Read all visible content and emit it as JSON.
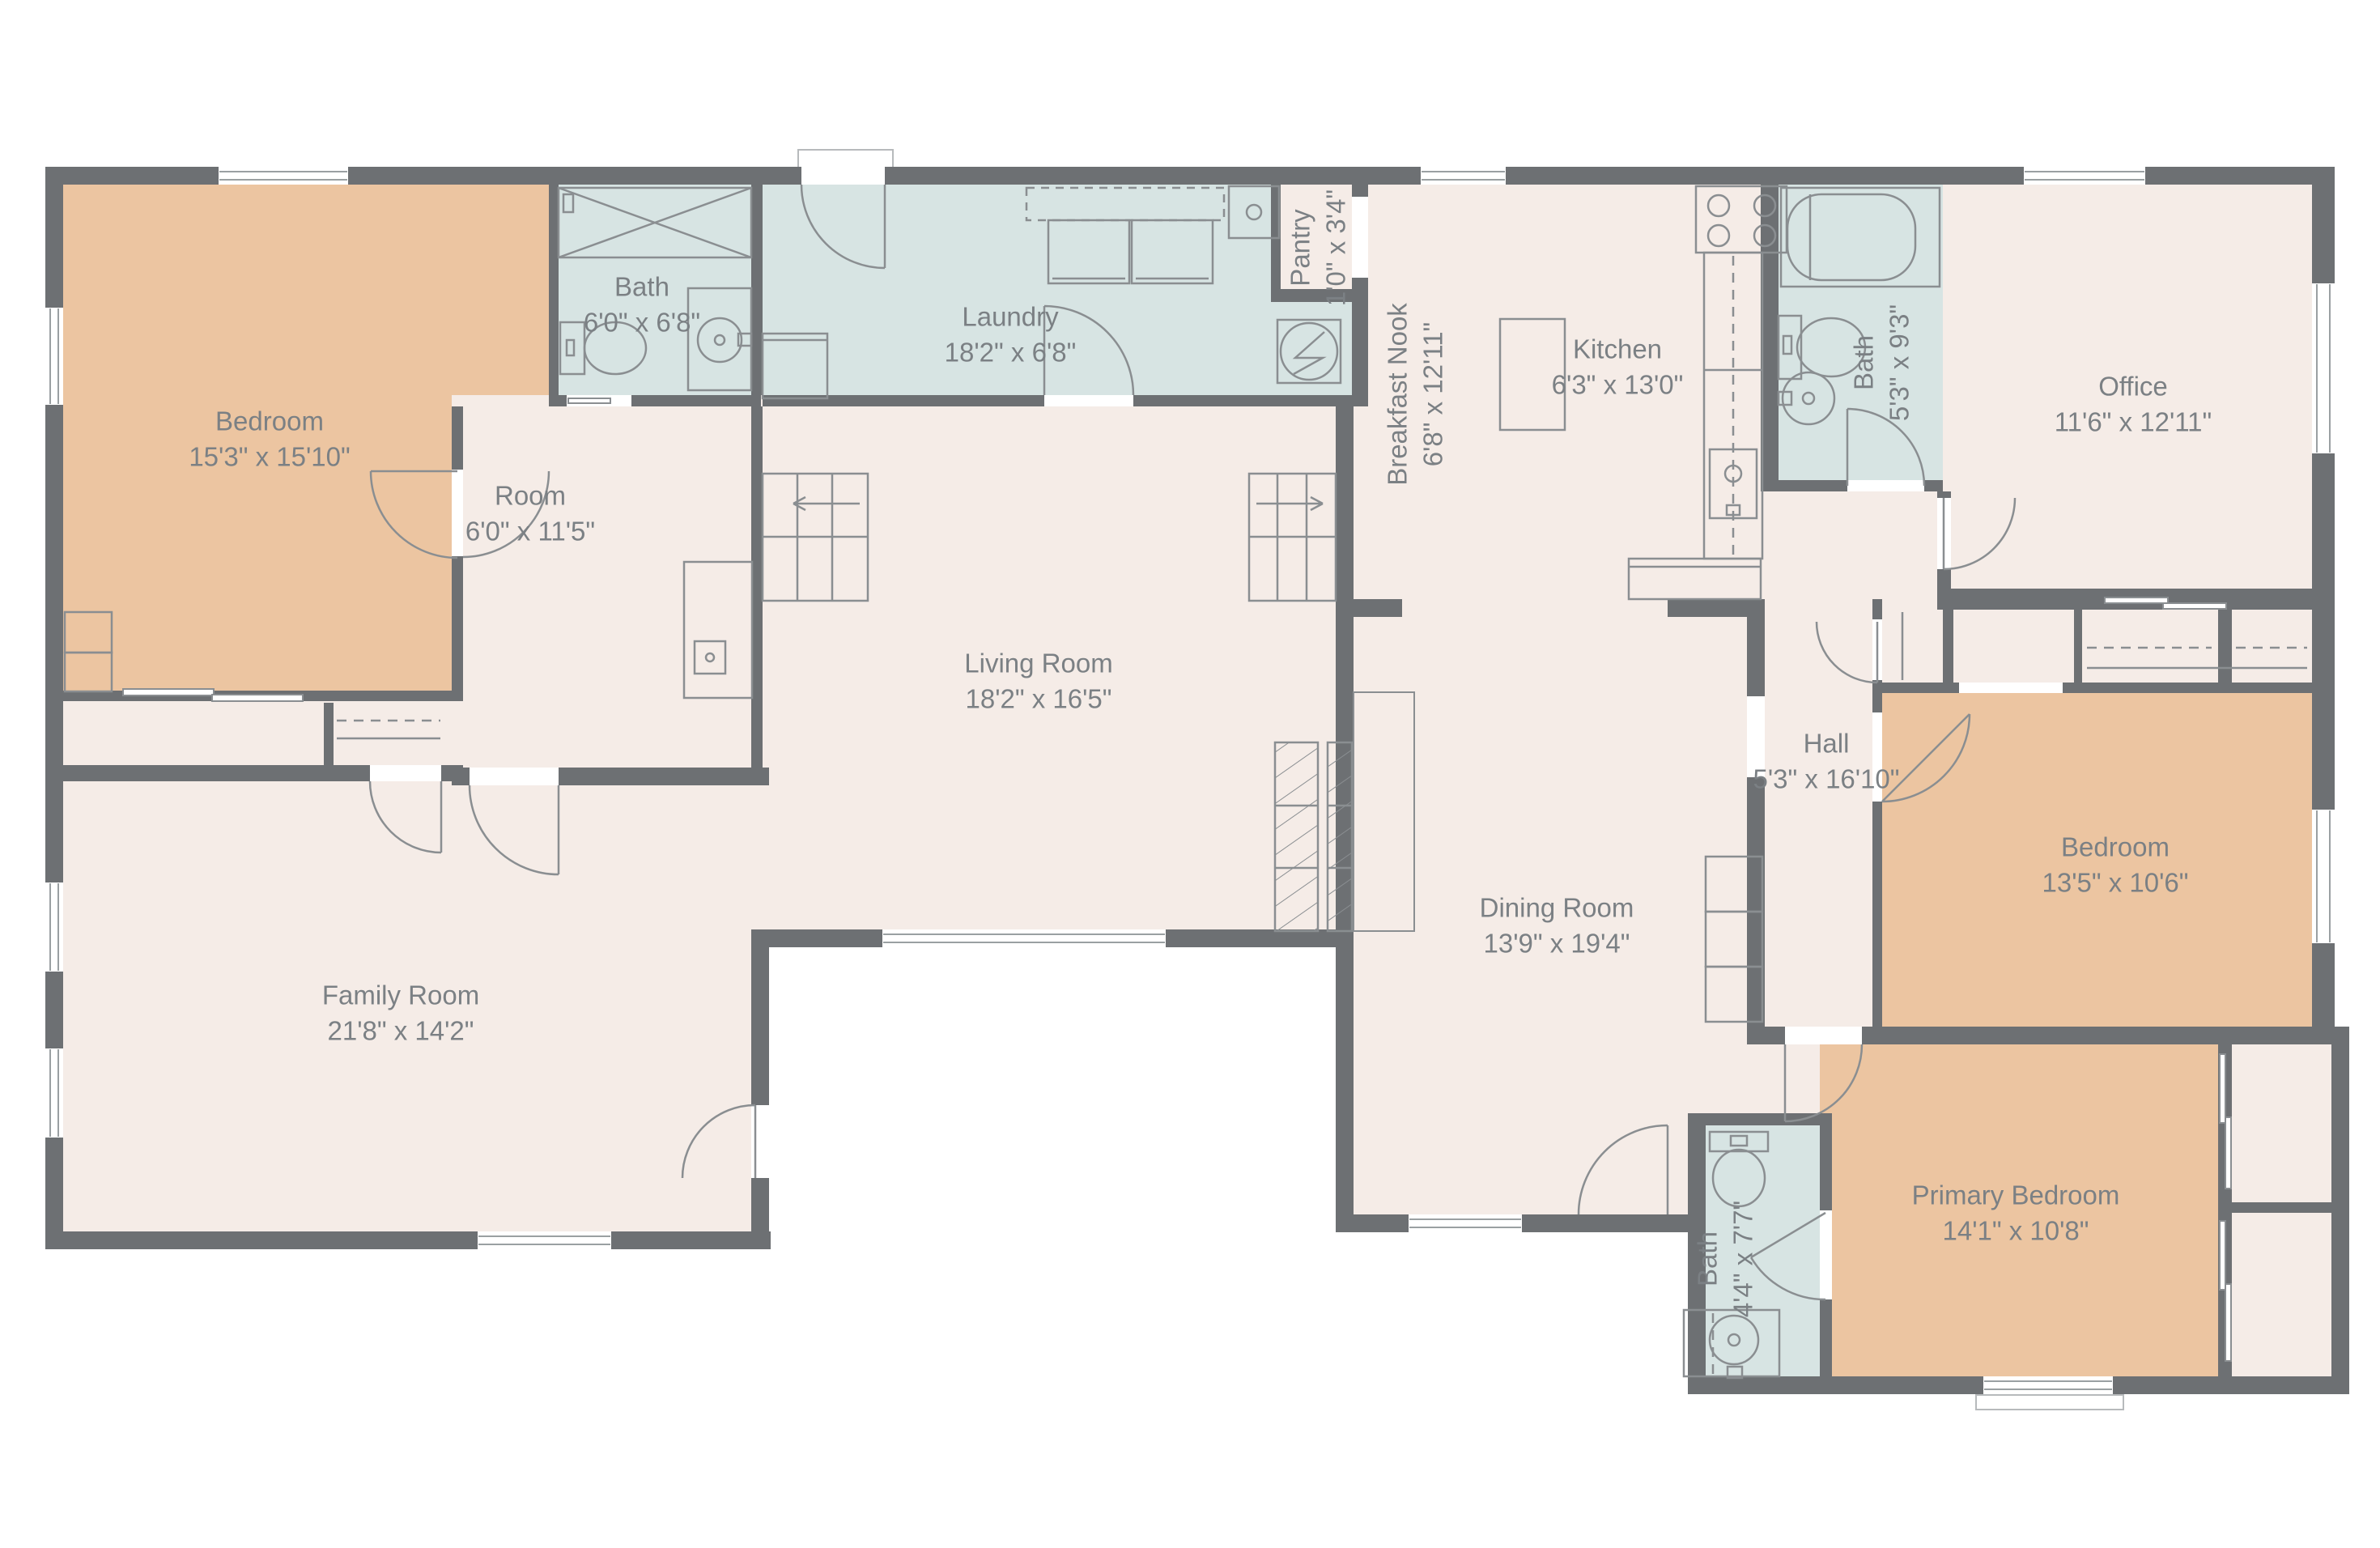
{
  "plan_title": "Floor plan",
  "colors": {
    "background": "#ffffff",
    "wall": "#6d7073",
    "floor_neutral": "#f5ece7",
    "floor_bedroom": "#ecc5a1",
    "floor_bath": "#d7e4e3",
    "fixture_line": "#8a8e91",
    "label_text": "#7b8084"
  },
  "rooms": [
    {
      "name": "Bedroom",
      "dims": "15'3\" x 15'10\""
    },
    {
      "name": "Bath",
      "dims": "6'0\" x 6'8\""
    },
    {
      "name": "Laundry",
      "dims": "18'2\" x 6'8\""
    },
    {
      "name": "Pantry",
      "dims": "1'0\" x 3'4\""
    },
    {
      "name": "Breakfast Nook",
      "dims": "6'8\" x 12'11\""
    },
    {
      "name": "Kitchen",
      "dims": "6'3\" x 13'0\""
    },
    {
      "name": "Bath",
      "dims": "5'3\" x 9'3\""
    },
    {
      "name": "Office",
      "dims": "11'6\" x 12'11\""
    },
    {
      "name": "Room",
      "dims": "6'0\" x 11'5\""
    },
    {
      "name": "Living Room",
      "dims": "18'2\" x 16'5\""
    },
    {
      "name": "Hall",
      "dims": "5'3\" x 16'10\""
    },
    {
      "name": "Bedroom",
      "dims": "13'5\" x 10'6\""
    },
    {
      "name": "Dining Room",
      "dims": "13'9\" x 19'4\""
    },
    {
      "name": "Family Room",
      "dims": "21'8\" x 14'2\""
    },
    {
      "name": "Primary Bedroom",
      "dims": "14'1\" x 10'8\""
    },
    {
      "name": "Bath",
      "dims": "4'4\" x 7'7\""
    }
  ]
}
